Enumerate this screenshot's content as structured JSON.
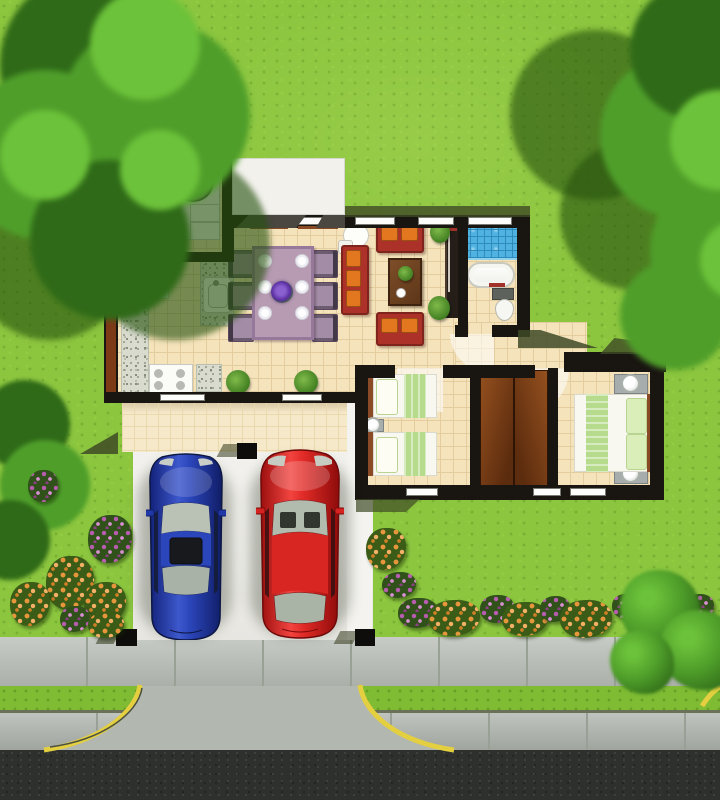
{
  "meta": {
    "description": "Aerial 3D floor-plan rendering of a single-storey house with garden, carport with two cars, and street"
  },
  "palette": {
    "grass": "#8CC63F",
    "tree": "#4F9E2A",
    "tree-dark": "#2F6A18",
    "tree-light": "#6CC23A",
    "floor": "#F4E3BB",
    "floor-line": "#E3CC9E",
    "patio": "#F6E9C9",
    "patio-line": "#EBD9AE",
    "wall": "#191511",
    "roof": "#F2F1EC",
    "wedge": "#49473F",
    "shadow-olive": "#3E4A26",
    "granite": "#D8DBCE",
    "sofa": "#AC3128",
    "cushion": "#E2771F",
    "wood": "#6F4423",
    "dining": "#B79BB3",
    "chair": "#A28CA6",
    "shower": "#4FB2E0",
    "shower-line": "#2E8BBB",
    "bed-green": "#B6DB8C",
    "pillow-green": "#D9EEB9",
    "headboard": "#8A4A26",
    "wardrobe1": "#94501F",
    "wardrobe2": "#5C2C0E",
    "car-blue": "#2038A8",
    "car-red": "#D62220",
    "glass": "#B7C0B2",
    "pad": "#EEEDE9",
    "path": "#F4F3EF",
    "sidewalk": "#B5BAB3",
    "joint": "#99A096",
    "verge": "#7FBB33",
    "curb": "#B2B7B0",
    "asphalt": "#2E302E",
    "yellow": "#E3CF3F",
    "flower-orange": "#E8963C",
    "flower-purple": "#B75CAE"
  },
  "scene": {
    "landscape": {
      "trees": [
        "top-left-tree",
        "top-right-tree"
      ],
      "bushes": [
        "left-leafy-bush",
        "front-right-bush"
      ],
      "flower_beds": [
        "left-side-cluster",
        "front-yard-cluster",
        "street-side-row"
      ],
      "flower_colors": [
        "orange",
        "purple"
      ]
    },
    "house": {
      "rooms": [
        {
          "name": "laundry-room",
          "furniture": [
            "washing-machine",
            "cabinet",
            "door-swing"
          ]
        },
        {
          "name": "kitchen",
          "furniture": [
            "fridge",
            "granite-counter",
            "island-with-sink",
            "stove"
          ]
        },
        {
          "name": "dining-area",
          "furniture": [
            "dining-table",
            "six-chairs",
            "place-settings",
            "flower-centerpiece"
          ]
        },
        {
          "name": "living-room",
          "furniture": [
            "three-seat-sofa",
            "two-loveseats",
            "coffee-table",
            "tv-console",
            "round-side-table",
            "potted-plants"
          ]
        },
        {
          "name": "bathroom",
          "furniture": [
            "blue-tile-shower",
            "bathtub",
            "toilet"
          ]
        },
        {
          "name": "twin-bedroom",
          "furniture": [
            "twin-bed",
            "twin-bed",
            "nightstand-with-lamp"
          ]
        },
        {
          "name": "closet",
          "furniture": [
            "double-wood-doors"
          ]
        },
        {
          "name": "master-bedroom",
          "furniture": [
            "double-bed",
            "nightstand-with-lamp",
            "nightstand-with-lamp"
          ]
        }
      ],
      "outdoor": [
        "white-flat-roofs",
        "covered-patio",
        "carport-posts"
      ]
    },
    "vehicles": [
      {
        "name": "blue-car",
        "color_key": "car-blue"
      },
      {
        "name": "red-car",
        "color_key": "car-red"
      }
    ],
    "street": [
      "sidewalk",
      "grass-verge",
      "curb-apron",
      "yellow-curb-lines",
      "asphalt-road",
      "flared-driveway-entrance"
    ]
  }
}
